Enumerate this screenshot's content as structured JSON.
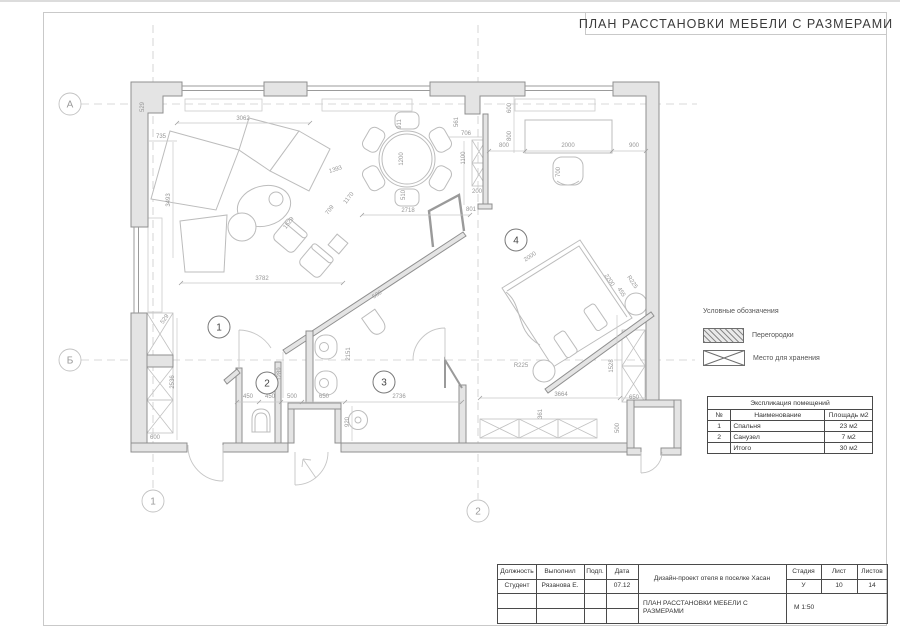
{
  "colors": {
    "wall_fill": "#e4e4e4",
    "wall_stroke": "#8f8f8f",
    "partition": "#9a9a9a",
    "furniture": "#bcbcbc",
    "dim": "#969696",
    "axis": "#cccccc",
    "frame": "#c9c9c9",
    "text": "#3f3f3f"
  },
  "title": "ПЛАН РАССТАНОВКИ МЕБЕЛИ С РАЗМЕРАМИ",
  "legend": {
    "heading": "Условные обозначения",
    "items": [
      {
        "name": "partitions-swatch",
        "label": "Перегородки"
      },
      {
        "name": "storage-swatch",
        "label": "Место для хранения"
      }
    ]
  },
  "explication": {
    "title": "Экспликация помещений",
    "headers": [
      "№",
      "Наименование",
      "Площадь м2"
    ],
    "rows": [
      [
        "1",
        "Спальня",
        "23 м2"
      ],
      [
        "2",
        "Санузел",
        "7 м2"
      ],
      [
        "",
        "Итого",
        "30 м2"
      ]
    ]
  },
  "stamp": {
    "labels": [
      "Должность",
      "Выполнил",
      "Подп.",
      "Дата",
      "Стадия",
      "Лист",
      "Листов"
    ],
    "position": "Студент",
    "author": "Рязанова Е.",
    "date": "07.12",
    "project": "Дизайн-проект отеля в поселке Хасан",
    "sheet_title": "ПЛАН РАССТАНОВКИ МЕБЕЛИ С РАЗМЕРАМИ",
    "stage": "У",
    "sheet": "10",
    "sheets": "14",
    "scale": "М 1:50"
  },
  "axes": [
    {
      "label": "А",
      "x": 70,
      "y": 104
    },
    {
      "label": "Б",
      "x": 70,
      "y": 360
    },
    {
      "label": "1",
      "x": 153,
      "y": 501
    },
    {
      "label": "2",
      "x": 478,
      "y": 511
    }
  ],
  "rooms": [
    {
      "number": "1",
      "x": 219,
      "y": 327
    },
    {
      "number": "2",
      "x": 267,
      "y": 383
    },
    {
      "number": "3",
      "x": 384,
      "y": 382
    },
    {
      "number": "4",
      "x": 516,
      "y": 240
    }
  ],
  "dimensions": [
    {
      "t": "3062",
      "x": 243,
      "y": 120,
      "r": 0
    },
    {
      "t": "735",
      "x": 161,
      "y": 138,
      "r": 0
    },
    {
      "t": "529",
      "x": 144,
      "y": 107,
      "r": -90
    },
    {
      "t": "3493",
      "x": 170,
      "y": 200,
      "r": -90
    },
    {
      "t": "1393",
      "x": 336,
      "y": 171,
      "r": -18
    },
    {
      "t": "1170",
      "x": 350,
      "y": 199,
      "r": -52
    },
    {
      "t": "709",
      "x": 331,
      "y": 211,
      "r": -52
    },
    {
      "t": "1529",
      "x": 290,
      "y": 224,
      "r": -52
    },
    {
      "t": "3782",
      "x": 262,
      "y": 280,
      "r": 0
    },
    {
      "t": "529",
      "x": 166,
      "y": 320,
      "r": -55
    },
    {
      "t": "2536",
      "x": 174,
      "y": 382,
      "r": -90
    },
    {
      "t": "600",
      "x": 155,
      "y": 439,
      "r": 0
    },
    {
      "t": "911",
      "x": 401,
      "y": 124,
      "r": -90
    },
    {
      "t": "1200",
      "x": 403,
      "y": 159,
      "r": -90
    },
    {
      "t": "510",
      "x": 405,
      "y": 195,
      "r": -90
    },
    {
      "t": "2718",
      "x": 408,
      "y": 212,
      "r": 0
    },
    {
      "t": "561",
      "x": 458,
      "y": 122,
      "r": -90
    },
    {
      "t": "706",
      "x": 466,
      "y": 135,
      "r": 0
    },
    {
      "t": "1100",
      "x": 465,
      "y": 158,
      "r": -90
    },
    {
      "t": "200",
      "x": 477,
      "y": 193,
      "r": 0
    },
    {
      "t": "801",
      "x": 471,
      "y": 211,
      "r": 0
    },
    {
      "t": "600",
      "x": 511,
      "y": 108,
      "r": -90
    },
    {
      "t": "800",
      "x": 511,
      "y": 136,
      "r": -90
    },
    {
      "t": "800",
      "x": 504,
      "y": 147,
      "r": 0
    },
    {
      "t": "2000",
      "x": 568,
      "y": 147,
      "r": 0
    },
    {
      "t": "900",
      "x": 634,
      "y": 147,
      "r": 0
    },
    {
      "t": "700",
      "x": 560,
      "y": 172,
      "r": -90
    },
    {
      "t": "580",
      "x": 378,
      "y": 296,
      "r": -33
    },
    {
      "t": "2151",
      "x": 350,
      "y": 354,
      "r": -90
    },
    {
      "t": "1289",
      "x": 281,
      "y": 374,
      "r": -90
    },
    {
      "t": "450",
      "x": 248,
      "y": 398,
      "r": 0
    },
    {
      "t": "450",
      "x": 270,
      "y": 398,
      "r": 0
    },
    {
      "t": "500",
      "x": 292,
      "y": 398,
      "r": 0
    },
    {
      "t": "650",
      "x": 324,
      "y": 398,
      "r": 0
    },
    {
      "t": "2736",
      "x": 399,
      "y": 398,
      "r": 0
    },
    {
      "t": "920",
      "x": 349,
      "y": 422,
      "r": -90
    },
    {
      "t": "2000",
      "x": 531,
      "y": 258,
      "r": -33
    },
    {
      "t": "2200",
      "x": 608,
      "y": 281,
      "r": 56
    },
    {
      "t": "455",
      "x": 620,
      "y": 293,
      "r": 56
    },
    {
      "t": "R225",
      "x": 631,
      "y": 283,
      "r": 56
    },
    {
      "t": "R225",
      "x": 521,
      "y": 367,
      "r": 0
    },
    {
      "t": "1528",
      "x": 613,
      "y": 366,
      "r": -90
    },
    {
      "t": "3664",
      "x": 561,
      "y": 396,
      "r": 0
    },
    {
      "t": "650",
      "x": 634,
      "y": 399,
      "r": 0
    },
    {
      "t": "361",
      "x": 542,
      "y": 414,
      "r": -90
    },
    {
      "t": "500",
      "x": 619,
      "y": 428,
      "r": -90
    }
  ]
}
